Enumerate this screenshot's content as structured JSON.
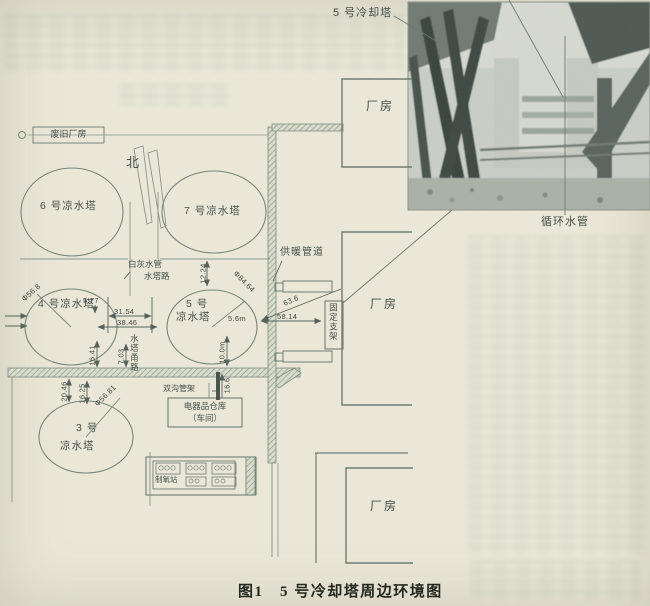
{
  "labels": {
    "caption": "图1　5 号冷却塔周边环境图",
    "photo_tower": "5 号冷却塔",
    "photo_pipe": "循环水管",
    "north": "北",
    "abandoned": "废旧厂房",
    "t6": "6 号凉水塔",
    "t7": "7 号凉水塔",
    "t4": "4 号凉水塔",
    "t5a": "5 号",
    "t5b": "凉水塔",
    "t3a": "3 号",
    "t3b": "凉水塔",
    "heating": "供暖管道",
    "lime": "白灰水管",
    "road1": "水塔路",
    "road2": "水塔甬路",
    "rack": "双沟管架",
    "support": "固定支架",
    "warehouse1": "电器品仓库",
    "warehouse2": "（车间）",
    "oxygen": "制氧站",
    "factory": "厂房"
  },
  "dims": {
    "d577": "5.77",
    "d3154": "31.54",
    "d3846": "38.46",
    "d5814": "58.14",
    "d636": "63.6",
    "d1224": "12.24",
    "d1641": "16.41",
    "d703": "7.03",
    "d2046": "20.46",
    "d1625": "16.25",
    "d166": "16.6",
    "d100m": "10.0m",
    "d56m": "5.6m",
    "phi568": "Φ56.8",
    "phi8464": "Φ84.64",
    "phi5681": "Φ56.81"
  },
  "colors": {
    "paper": "#eae7d8",
    "line": "#7b887e",
    "text": "#3f4a44",
    "photo_dark": "#39443e"
  }
}
